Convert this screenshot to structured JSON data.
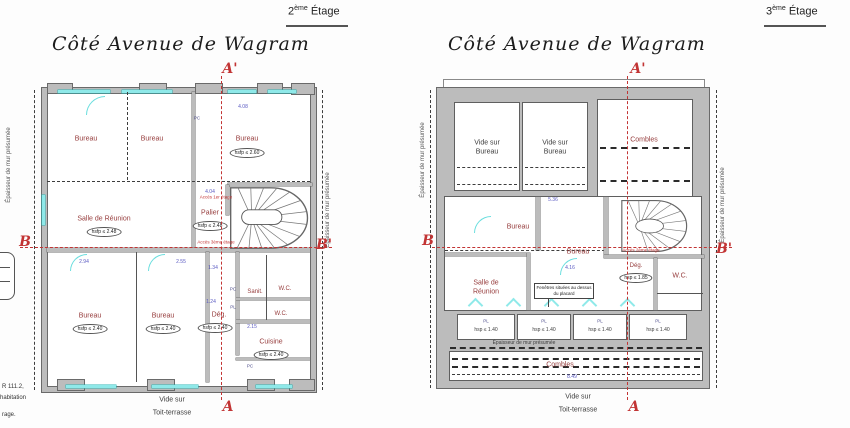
{
  "colors": {
    "wall_gray": "#bcbcbc",
    "room_label_red": "#963c3c",
    "section_red": "#c23434",
    "window_cyan": "#8fe9e9",
    "dim_blue": "#5a5ac2"
  },
  "left": {
    "floor_num": "2",
    "floor_sup": "ème",
    "floor_word": "Étage",
    "title": "Côté Avenue de Wagram",
    "sec_a_top": "A'",
    "sec_a_bottom": "A",
    "sec_b_left": "B",
    "sec_b_right": "B'",
    "rooms": {
      "bureau_nw": "Bureau",
      "bureau_n": "Bureau",
      "bureau_ne": "Bureau",
      "bureau_ne_h": "hsfp ≤ 2.60",
      "salle": "Salle de Réunion",
      "salle_h": "hsfp ≤ 2.48",
      "palier": "Palier",
      "palier_h": "hsfp ≤ 2.48",
      "acces_1": "Accès 1er étage",
      "acces_3": "Accès 3ème étage",
      "bureau_sw": "Bureau",
      "bureau_sw_h": "hsfp ≤ 2.40",
      "bureau_s": "Bureau",
      "bureau_s_h": "hsfp ≤ 2.40",
      "deg": "Dég.",
      "deg_h": "hsfp ≤ 2.40",
      "sanit": "Sanit.",
      "wc1": "W.C.",
      "wc2": "W.C.",
      "cuisine": "Cuisine",
      "cuisine_h": "hsfp ≤ 2.40"
    },
    "vide_line1": "Vide sur",
    "vide_line2": "Toit-terrasse",
    "wall_note": "Épaisseur de mur présumée",
    "dims": {
      "d1": "4.08",
      "d2": "4.04",
      "d3": "2.94",
      "d4": "2.55",
      "d5": "1.34",
      "d6": "1.24",
      "d7": "2.15"
    },
    "tags": {
      "pc1": "PC",
      "pc2": "PC",
      "pl": "PL",
      "pc3": "PC"
    }
  },
  "right": {
    "floor_num": "3",
    "floor_sup": "ème",
    "floor_word": "Étage",
    "title": "Côté Avenue de Wagram",
    "sec_a_top": "A'",
    "sec_a_bottom": "A",
    "sec_b_left": "B",
    "sec_b_right": "B'",
    "rooms": {
      "vide_bureau_1": "Vide sur Bureau",
      "vide_bureau_2": "Vide sur Bureau",
      "combles_top": "Combles",
      "bureau_c": "Bureau",
      "bureau_e": "Bureau",
      "salle": "Salle de Réunion",
      "deg": "Dég.",
      "deg_h": "hsp ≤ 1.85",
      "wc": "W.C.",
      "acces_2": "Accès 2ème étage",
      "combles_bottom": "Combles"
    },
    "note": "Fenêtres situées au dessus du placard",
    "pl": "PL",
    "pl_h": "hsp ≤ 1.40",
    "wall_note": "Épaisseur de mur présumée",
    "dims": {
      "d1": "5.36",
      "d2": "4.16",
      "d3": "8.49"
    },
    "vide_line1": "Vide sur",
    "vide_line2": "Toit-terrasse"
  },
  "fragments": {
    "f1": "R 111.2,",
    "f2": "habitation",
    "f3": "rage."
  }
}
